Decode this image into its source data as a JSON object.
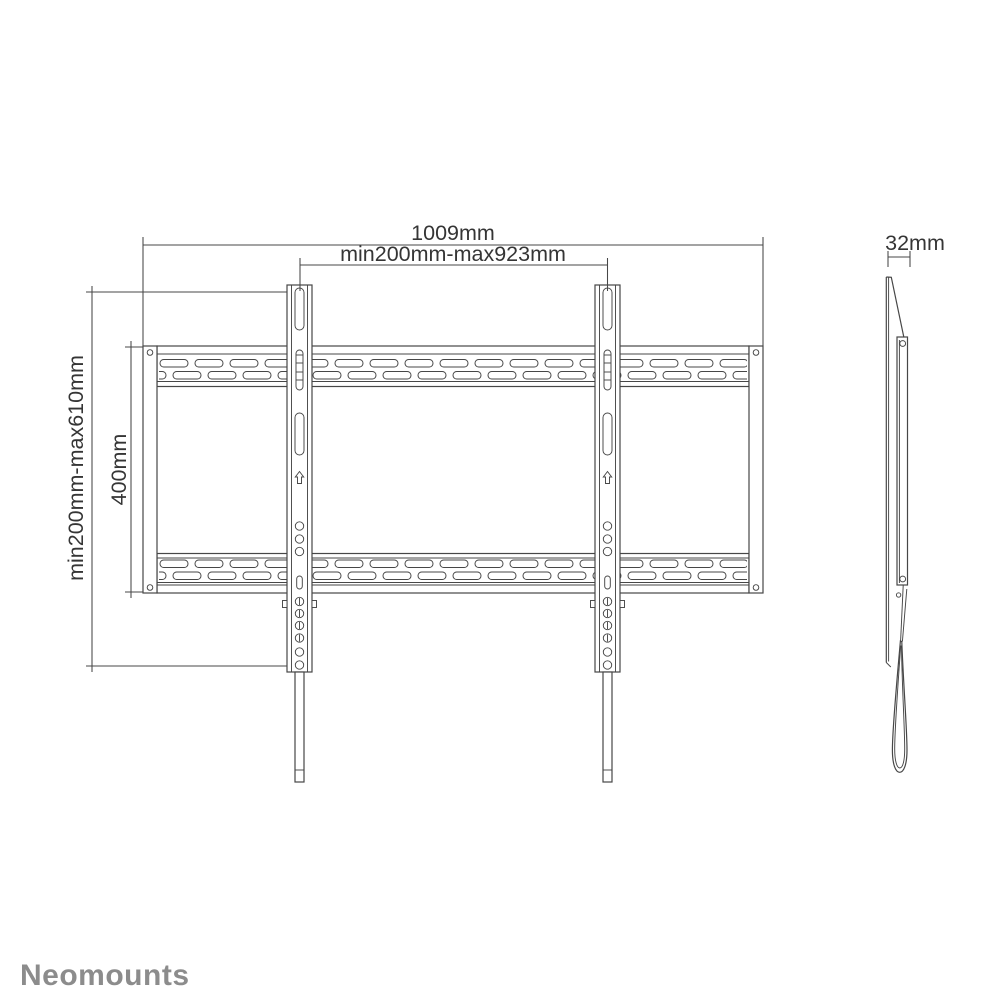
{
  "colors": {
    "line": "#474747",
    "text": "#353535",
    "logo": "#8c8c8c",
    "background": "#ffffff"
  },
  "front_view": {
    "total_width_label": "1009mm",
    "hole_width_range_label": "min200mm-max923mm",
    "hole_height_range_label": "min200mm-max610mm",
    "vesa_height_label": "400mm"
  },
  "side_view": {
    "depth_label": "32mm"
  },
  "branding": {
    "logo_text": "Neomounts"
  }
}
